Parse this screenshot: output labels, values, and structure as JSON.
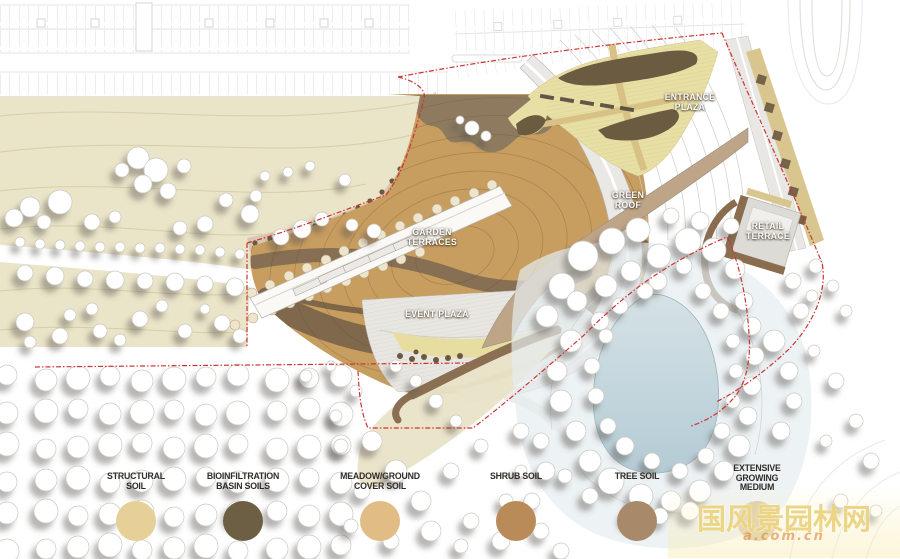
{
  "plan_labels": {
    "entrance_plaza": {
      "line1": "ENTRANCE",
      "line2": "PLAZA"
    },
    "garden_terraces": {
      "line1": "GARDEN",
      "line2": "TERRACES"
    },
    "green_roof": {
      "line1": "GREEN",
      "line2": "ROOF"
    },
    "event_plaza": {
      "line1": "EVENT PLAZA"
    },
    "retail_terrace": {
      "line1": "RETAIL",
      "line2": "TERRACE"
    }
  },
  "legend": {
    "items": [
      {
        "line1": "STRUCTURAL",
        "line2": "SOIL",
        "color": "#e7d098"
      },
      {
        "line1": "BIOINFILTRATION",
        "line2": "BASIN SOILS",
        "color": "#6d5f44"
      },
      {
        "line1": "MEADOW/GROUND",
        "line2": "COVER SOIL",
        "color": "#e2bc85"
      },
      {
        "line1": "SHRUB SOIL",
        "color": "#b88b59"
      },
      {
        "line1": "TREE SOIL",
        "color": "#a8896a"
      },
      {
        "line1": "EXTENSIVE",
        "line2": "GROWING",
        "line3": "MEDIUM",
        "color": "#dbcba1"
      }
    ]
  },
  "watermark": {
    "text": "国风景园林网",
    "subtext": "a.com.cn"
  },
  "boundary_color": "#cc3333"
}
